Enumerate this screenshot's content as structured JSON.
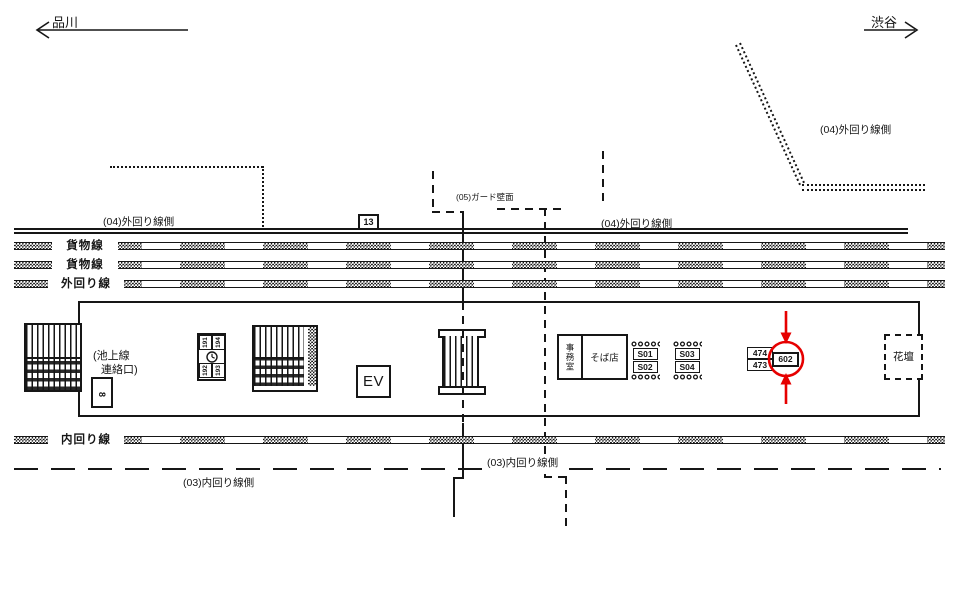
{
  "header": {
    "left_station": "品川",
    "right_station": "渋谷"
  },
  "zones": {
    "outer_side_left": "(04)外回り線側",
    "outer_side_right": "(04)外回り線側",
    "outer_side_top_right": "(04)外回り線側",
    "guard_wall": "(05)ガード壁面",
    "inner_side_center": "(03)内回り線側",
    "inner_side_left": "(03)内回り線側"
  },
  "tracks": [
    {
      "label": "貨物線"
    },
    {
      "label": "貨物線"
    },
    {
      "label": "外回り線"
    },
    {
      "label": "内回り線"
    }
  ],
  "platform": {
    "marker_13": "13",
    "connection_note_line1": "(池上線",
    "connection_note_line2": "連絡口)",
    "sign_8": "8",
    "plate_numbers": {
      "top_left": "191",
      "top_right": "194",
      "bottom_left": "192",
      "bottom_right": "193"
    },
    "elevator": "EV",
    "office": "事務室",
    "soba_shop": "そば店",
    "s_plates": [
      [
        "S01",
        "S02"
      ],
      [
        "S03",
        "S04"
      ]
    ],
    "boards": {
      "top": "474",
      "bottom": "473",
      "highlighted": "602"
    },
    "flower_bed": "花壇"
  },
  "colors": {
    "ink": "#161616",
    "highlight": "#e60000"
  }
}
